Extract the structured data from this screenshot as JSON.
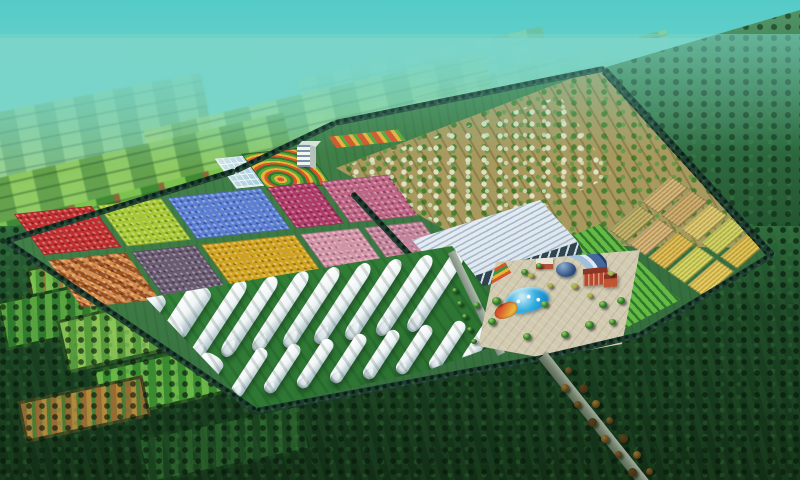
{
  "scene": {
    "description": "Bird's-eye 3D architectural rendering of a planned agricultural demonstration park: colorful crop trial plots, a fruit-tree orchard, golden grain plots, a large glass greenhouse, rows of white plastic tunnel greenhouses and a central visitor plaza with pool, all inside a tree-lined boundary wall surrounded by patchwork farmland fading into teal haze",
    "view": "aerial oblique",
    "time": "daytime"
  },
  "palette": {
    "sky_top": "#54cbc8",
    "sky_mid": "#74d4c6",
    "sky_horizon": "#9adfc4",
    "complex_lawn": "#3c7a44",
    "wall_hedge": "#1f3d31",
    "pavement": "#d2cbb2",
    "pool_blue": "#1a8cc8",
    "tunnel_white": "#eef4f6",
    "glass_roof": "#e6edf4",
    "glass_facade": "#2e4550",
    "orchard_soil": "#a89a5f",
    "orchard_tree": "#4c8030",
    "orchard_blossom": "#e4ead2",
    "road_gray": "#75846f",
    "dome_blue": "#2e4f80",
    "arc_roof": "#46699c",
    "brick_red": "#b5492c"
  },
  "regions": [
    {
      "id": "distant-farmland",
      "label": "patchwork farmland fading to horizon"
    },
    {
      "id": "crop-plot-grid",
      "label": "colorful demonstration crop plots"
    },
    {
      "id": "ornamental-garden",
      "label": "swirl flower garden with office building"
    },
    {
      "id": "orchard",
      "label": "fruit tree orchard on tilled soil"
    },
    {
      "id": "wheat-plots",
      "label": "golden grain trial plots"
    },
    {
      "id": "vineyard-rows",
      "label": "green row crops"
    },
    {
      "id": "glass-greenhouse",
      "label": "large glass exhibition greenhouse"
    },
    {
      "id": "tunnel-greenhouses",
      "label": "white plastic tunnel greenhouses"
    },
    {
      "id": "central-plaza",
      "label": "visitor plaza with pool, arc building and red dormitories"
    },
    {
      "id": "entrance-road",
      "label": "tree-lined entrance road"
    },
    {
      "id": "boundary-wall",
      "label": "tree-lined boundary wall"
    }
  ],
  "crop_plots": {
    "row_heights": [
      44,
      50
    ],
    "rows": [
      [
        {
          "name": "red-flower-plot",
          "color": "#c22f2f",
          "w": 78
        },
        {
          "name": "chartreuse-plot",
          "color": "#a6c832",
          "w": 64
        },
        {
          "name": "blue-flower-plot",
          "color": "#5b7fd4",
          "w": 94
        },
        {
          "name": "magenta-plot",
          "color": "#b03a68",
          "w": 48
        },
        {
          "name": "rose-plot",
          "color": "#bf6484",
          "w": 68
        }
      ],
      [
        {
          "name": "orange-checker-plot",
          "color": "#c07038",
          "w": 78,
          "pattern": "checker"
        },
        {
          "name": "mauve-plot",
          "color": "#6a5a72",
          "w": 64
        },
        {
          "name": "gold-plot",
          "color": "#d0a21e",
          "w": 94
        },
        {
          "name": "light-pink-plot",
          "color": "#d494a8",
          "w": 58
        },
        {
          "name": "dusty-pink-plot",
          "color": "#c4839a",
          "w": 58
        }
      ]
    ]
  },
  "wheat_plots": {
    "rows": [
      [
        "#c9a968",
        "#c4a05e",
        "#d8c160",
        "#c8cc52",
        "#d9b93f"
      ],
      [
        "#b5a75a",
        "#cfa96b",
        "#d9b23f",
        "#cdd04f",
        "#e0c24a"
      ]
    ]
  },
  "greenhouse_tunnels": {
    "tilt_deg": 33,
    "rows": [
      {
        "name": "back-row",
        "start": [
          158,
          292
        ],
        "slope": -0.132,
        "items": [
          {
            "w": 26,
            "l": 58,
            "adv": 46
          },
          {
            "w": 24,
            "l": 58,
            "adv": 40
          },
          {
            "w": 14,
            "l": 94,
            "adv": 31
          },
          {
            "w": 14,
            "l": 94,
            "adv": 31
          },
          {
            "w": 14,
            "l": 94,
            "adv": 31
          },
          {
            "w": 14,
            "l": 94,
            "adv": 31
          },
          {
            "w": 14,
            "l": 94,
            "adv": 31
          },
          {
            "w": 14,
            "l": 94,
            "adv": 31
          },
          {
            "w": 14,
            "l": 94,
            "adv": 31
          },
          {
            "w": 14,
            "l": 94,
            "adv": 31
          }
        ]
      },
      {
        "name": "front-row",
        "start": [
          216,
          356
        ],
        "slope": -0.14,
        "items": [
          {
            "w": 24,
            "l": 50,
            "adv": 48
          },
          {
            "w": 13,
            "l": 56,
            "adv": 33
          },
          {
            "w": 13,
            "l": 56,
            "adv": 33
          },
          {
            "w": 13,
            "l": 56,
            "adv": 33
          },
          {
            "w": 13,
            "l": 56,
            "adv": 33
          },
          {
            "w": 13,
            "l": 56,
            "adv": 33
          },
          {
            "w": 13,
            "l": 56,
            "adv": 33
          },
          {
            "w": 13,
            "l": 56,
            "adv": 33
          },
          {
            "w": 13,
            "l": 56,
            "adv": 33
          }
        ]
      }
    ]
  },
  "plaza": {
    "pool": {
      "color": "#1a8cc8",
      "fountains": 3
    },
    "flowerbed_colors": [
      "#d8542c",
      "#e8b43a",
      "#3f9440"
    ],
    "buildings": [
      {
        "name": "exhibition-hall-arc",
        "roof": "#46699c"
      },
      {
        "name": "dome",
        "color": "#2e4f80"
      },
      {
        "name": "dormitory-red",
        "color": "#b5492c"
      },
      {
        "name": "office-red",
        "color": "#a8402a"
      }
    ],
    "trees": [
      {
        "x": 492,
        "y": 297,
        "s": 9,
        "c": "#2e7a28"
      },
      {
        "x": 488,
        "y": 318,
        "s": 8,
        "c": "#2e7a28"
      },
      {
        "x": 473,
        "y": 302,
        "s": 7,
        "c": "#2e7a28"
      },
      {
        "x": 521,
        "y": 269,
        "s": 7,
        "c": "#2e7a28"
      },
      {
        "x": 536,
        "y": 263,
        "s": 6,
        "c": "#3a8a30"
      },
      {
        "x": 599,
        "y": 301,
        "s": 8,
        "c": "#2e7a28"
      },
      {
        "x": 617,
        "y": 297,
        "s": 8,
        "c": "#2e7a28"
      },
      {
        "x": 585,
        "y": 321,
        "s": 9,
        "c": "#2e7a28"
      },
      {
        "x": 561,
        "y": 331,
        "s": 8,
        "c": "#2e7a28"
      },
      {
        "x": 541,
        "y": 301,
        "s": 7,
        "c": "#3a8a30"
      },
      {
        "x": 523,
        "y": 333,
        "s": 8,
        "c": "#2e7a28"
      },
      {
        "x": 609,
        "y": 319,
        "s": 7,
        "c": "#2e7a28"
      },
      {
        "x": 571,
        "y": 283,
        "s": 7,
        "c": "#b89f3e"
      },
      {
        "x": 587,
        "y": 293,
        "s": 6,
        "c": "#b89f3e"
      },
      {
        "x": 547,
        "y": 283,
        "s": 6,
        "c": "#b89f3e"
      },
      {
        "x": 608,
        "y": 271,
        "s": 6,
        "c": "#b89f3e"
      },
      {
        "x": 528,
        "y": 273,
        "s": 6,
        "c": "#b89f3e"
      },
      {
        "x": 452,
        "y": 288,
        "s": 6,
        "c": "#1f5c22"
      },
      {
        "x": 457,
        "y": 301,
        "s": 6,
        "c": "#1f5c22"
      },
      {
        "x": 462,
        "y": 314,
        "s": 6,
        "c": "#1f5c22"
      },
      {
        "x": 467,
        "y": 327,
        "s": 6,
        "c": "#1f5c22"
      },
      {
        "x": 471,
        "y": 339,
        "s": 6,
        "c": "#1f5c22"
      }
    ]
  },
  "ghouse_trees": [
    {
      "x": 444,
      "y": 246,
      "c": "#b89f3e"
    },
    {
      "x": 437,
      "y": 256,
      "c": "#3a8a30"
    },
    {
      "x": 430,
      "y": 266,
      "c": "#b89f3e"
    },
    {
      "x": 423,
      "y": 276,
      "c": "#3a8a30"
    },
    {
      "x": 416,
      "y": 286,
      "c": "#b89f3e"
    },
    {
      "x": 410,
      "y": 294,
      "c": "#3a8a30"
    }
  ],
  "entrance_road": {
    "tree_count": 14,
    "start": [
      551,
      360
    ],
    "tree_colors": [
      "#7a5a2a",
      "#97712f",
      "#55401e"
    ]
  },
  "walls": [
    {
      "x": 6,
      "y": 238,
      "len": 240,
      "ang": -17
    },
    {
      "x": 235,
      "y": 168,
      "len": 111,
      "ang": -25.6
    },
    {
      "x": 335,
      "y": 120,
      "len": 275,
      "ang": -11.4
    },
    {
      "x": 604,
      "y": 66,
      "len": 251,
      "ang": 47.9,
      "h": 8
    },
    {
      "x": 640,
      "y": 332,
      "len": 155,
      "ang": -31.2
    },
    {
      "x": 546,
      "y": 354,
      "len": 97,
      "ang": -13.2
    },
    {
      "x": 256,
      "y": 408,
      "len": 295,
      "ang": -10.5
    },
    {
      "x": 6,
      "y": 238,
      "len": 302,
      "ang": 34.2
    }
  ]
}
